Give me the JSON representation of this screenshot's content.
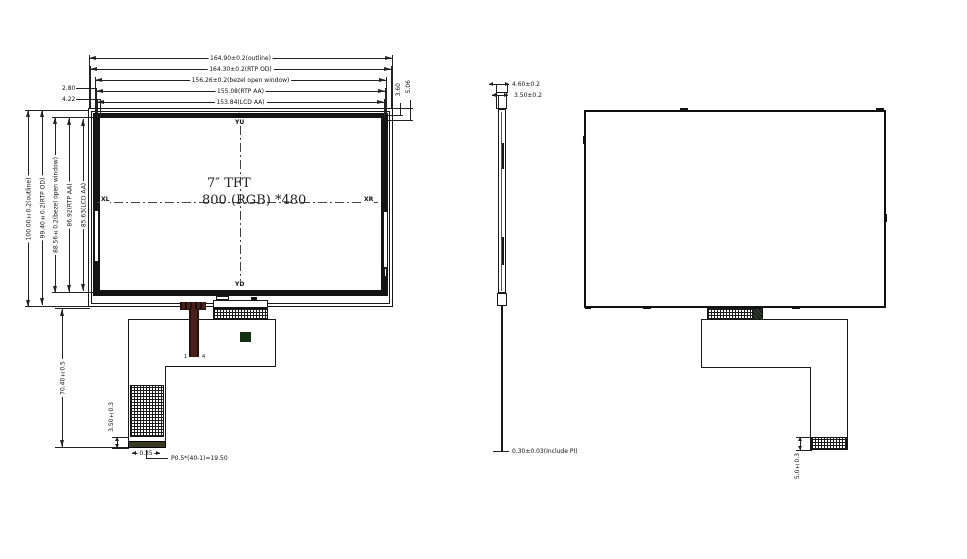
{
  "front": {
    "screen": {
      "size_label": "7″  TFT",
      "resolution_label": "800 (RGB) *480",
      "xl": "XL",
      "xr": "XR",
      "yu": "YU",
      "yd": "YD"
    },
    "dims_top": [
      {
        "label": "164.90±0.2(outline)"
      },
      {
        "label": "164.30±0.2(RTP OD)"
      },
      {
        "label": "156.26±0.2(bezel open window)"
      },
      {
        "label": "155.08(RTP AA)"
      },
      {
        "label": "153.84(LCD AA)"
      }
    ],
    "dims_left": [
      {
        "label": "100.00±0.2(outline)"
      },
      {
        "label": "99.40±0.2(RTP OD)"
      },
      {
        "label": "88.56±0.2(bezel open window)"
      },
      {
        "label": "86.92(RTP AA)"
      },
      {
        "label": "85.63(LCD AA)"
      }
    ],
    "dims_corner": {
      "tl1": "2.80",
      "tl2": "4.22",
      "tr1": "3.60",
      "tr2": "5.06"
    },
    "fpc": {
      "dim_height": "70.40±0.5",
      "dim_stiffener": "3.50±0.3",
      "dim_offset": "0.35",
      "dim_pitch": "P0.5*(40-1)=19.50",
      "pin_first": "1",
      "pin_last": "4"
    }
  },
  "side": {
    "dim_total": "4.60±0.2",
    "dim_panel": "3.50±0.2",
    "dim_fpc": "0.30±0.03(Include PI)"
  },
  "rear": {
    "fpc": {
      "dim_stiffener": "5.0±0.3"
    }
  },
  "colors": {
    "line": "#222222",
    "bezel": "#141414",
    "fpc_cable": "#4a201a",
    "cable_edge": "#2d0f0c",
    "stiffener": "#3a3a22",
    "component": "#163016",
    "tail": "#2e3b2e",
    "background": "#ffffff"
  }
}
